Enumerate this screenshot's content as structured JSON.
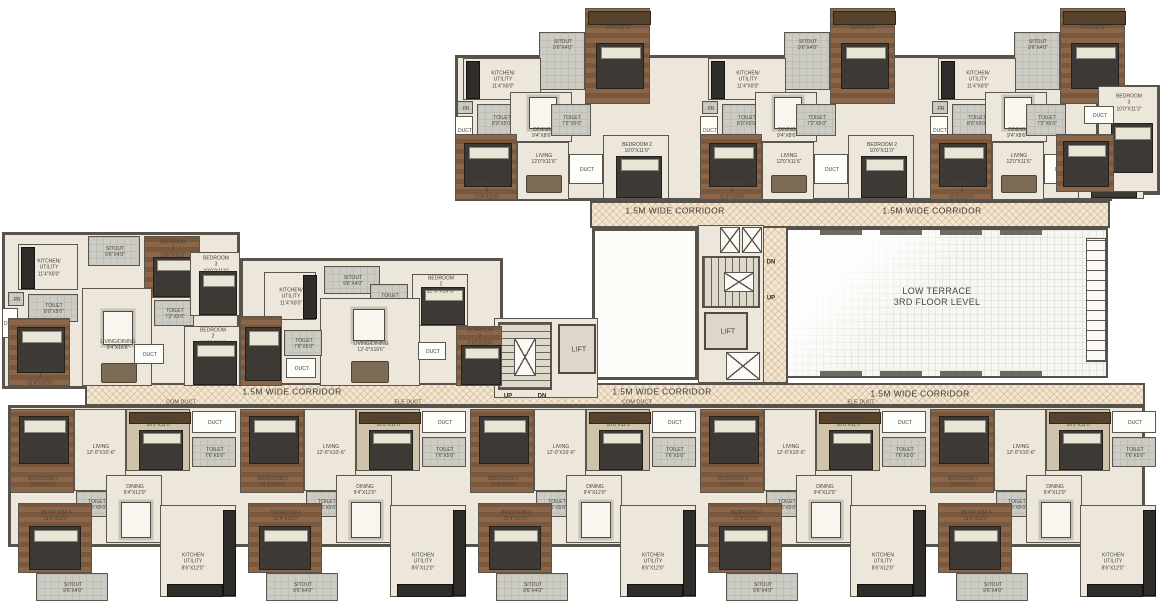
{
  "canvas": {
    "w": 1160,
    "h": 605
  },
  "colors": {
    "wall": "#57534b",
    "cream": "#ece7da",
    "wood": "#8a674a",
    "corridor_base": "#f2e6d3",
    "hatch": "#ba935e",
    "terrace": "#f6f6f2",
    "label": "#46423b"
  },
  "terrace": {
    "x": 786,
    "y": 228,
    "w": 322,
    "h": 150,
    "line1": "LOW TERRACE",
    "line2": "3RD FLOOR LEVEL",
    "louver": {
      "x": 1086,
      "y": 238,
      "w": 20,
      "h": 124
    },
    "edge_marks_top": [
      820,
      880,
      940,
      1000
    ],
    "edge_marks_bottom": [
      820,
      880,
      940,
      1000
    ]
  },
  "white_room": {
    "x": 592,
    "y": 228,
    "w": 106,
    "h": 152
  },
  "slabs": [
    {
      "x": 455,
      "y": 55,
      "w": 657,
      "h": 146
    },
    {
      "x": 1096,
      "y": 85,
      "w": 64,
      "h": 110
    },
    {
      "x": 2,
      "y": 232,
      "w": 238,
      "h": 157
    },
    {
      "x": 240,
      "y": 258,
      "w": 263,
      "h": 131
    },
    {
      "x": 8,
      "y": 405,
      "w": 1137,
      "h": 142
    }
  ],
  "corridors": [
    {
      "x": 590,
      "y": 201,
      "w": 520,
      "h": 27,
      "labels": [
        {
          "text": "1.5M WIDE CORRIDOR",
          "cx": 675,
          "cy": 211
        },
        {
          "text": "1.5M WIDE CORRIDOR",
          "cx": 932,
          "cy": 211
        }
      ]
    },
    {
      "x": 762,
      "y": 226,
      "w": 26,
      "h": 158,
      "labels": []
    },
    {
      "x": 85,
      "y": 383,
      "w": 1060,
      "h": 23,
      "labels": [
        {
          "text": "1.5M WIDE CORRIDOR",
          "cx": 292,
          "cy": 392
        },
        {
          "text": "1.5M WIDE CORRIDOR",
          "cx": 662,
          "cy": 392
        },
        {
          "text": "1.5M WIDE CORRIDOR",
          "cx": 920,
          "cy": 394
        }
      ]
    }
  ],
  "duct_tags": [
    {
      "text": "COM DUCT",
      "cx": 181,
      "cy": 403
    },
    {
      "text": "ELE DUCT",
      "cx": 408,
      "cy": 403
    },
    {
      "text": "COM DUCT",
      "cx": 637,
      "cy": 403
    },
    {
      "text": "ELE DUCT",
      "cx": 861,
      "cy": 403
    }
  ],
  "cores": [
    {
      "name": "core-1",
      "frame": {
        "x": 494,
        "y": 318,
        "w": 104,
        "h": 80
      },
      "stair": {
        "x": 498,
        "y": 322,
        "w": 54,
        "h": 68,
        "dir": "v"
      },
      "mid_x": {
        "x": 514,
        "y": 338,
        "w": 22,
        "h": 38
      },
      "lift": {
        "x": 558,
        "y": 324,
        "w": 38,
        "h": 50,
        "label": "LIFT"
      },
      "xboxes": [],
      "updn": [
        {
          "text": "UP",
          "cx": 508,
          "cy": 397
        },
        {
          "text": "DN",
          "cx": 542,
          "cy": 397
        }
      ]
    },
    {
      "name": "core-2",
      "frame": {
        "x": 698,
        "y": 225,
        "w": 66,
        "h": 158
      },
      "stair": {
        "x": 702,
        "y": 256,
        "w": 58,
        "h": 52,
        "dir": "h"
      },
      "mid_x": {
        "x": 724,
        "y": 272,
        "w": 30,
        "h": 20
      },
      "lift": {
        "x": 704,
        "y": 312,
        "w": 44,
        "h": 38,
        "label": "LIFT"
      },
      "xboxes": [
        {
          "x": 720,
          "y": 227,
          "w": 20,
          "h": 26
        },
        {
          "x": 742,
          "y": 227,
          "w": 20,
          "h": 26
        },
        {
          "x": 726,
          "y": 352,
          "w": 34,
          "h": 28
        }
      ],
      "updn": [
        {
          "text": "DN",
          "cx": 771,
          "cy": 263
        },
        {
          "text": "UP",
          "cx": 771,
          "cy": 299
        }
      ]
    }
  ],
  "unit_templates": {
    "top_unit": {
      "rooms": [
        {
          "x": 130,
          "y": 0,
          "w": 65,
          "h": 96,
          "f": "wood",
          "label": "BEDROOM 3",
          "dims": "10'0\"X11'3\"",
          "l": [
            32,
            16
          ],
          "furn": [
            {
              "t": "ward",
              "x": 2,
              "y": 2,
              "w": 61,
              "h": 12
            },
            {
              "t": "bed",
              "x": 10,
              "y": 34,
              "w": 46,
              "h": 44
            }
          ]
        },
        {
          "x": 84,
          "y": 24,
          "w": 46,
          "h": 58,
          "f": "gray",
          "label": "SITOUT",
          "dims": "9'6\"X4'0\"",
          "l": [
            23,
            12
          ],
          "furn": []
        },
        {
          "x": 8,
          "y": 50,
          "w": 78,
          "h": 42,
          "f": "cream",
          "label": "KITCHEN/\nUTILITY",
          "dims": "11'4\"X8'0\"",
          "furn": [
            {
              "t": "counter",
              "x": 2,
              "y": 2,
              "w": 12,
              "h": 36
            }
          ]
        },
        {
          "x": 2,
          "y": 93,
          "w": 16,
          "h": 13,
          "f": "gray",
          "label": "PR",
          "furn": []
        },
        {
          "x": 0,
          "y": 108,
          "w": 18,
          "h": 28,
          "f": "white",
          "label": "DUCT",
          "furn": []
        },
        {
          "x": 22,
          "y": 96,
          "w": 48,
          "h": 32,
          "f": "gray",
          "label": "TOILET",
          "dims": "8'0\"X5'0\"",
          "furn": []
        },
        {
          "x": 55,
          "y": 84,
          "w": 62,
          "h": 50,
          "f": "cream",
          "label": "DINING",
          "dims": "9'4\"X8'6\"",
          "l": [
            31,
            40
          ],
          "furn": [
            {
              "t": "table",
              "x": 18,
              "y": 4,
              "w": 26,
              "h": 30
            }
          ]
        },
        {
          "x": 96,
          "y": 96,
          "w": 40,
          "h": 32,
          "f": "gray",
          "label": "TOILET",
          "dims": "7'2\"X5'0\"",
          "furn": []
        },
        {
          "x": 0,
          "y": 126,
          "w": 62,
          "h": 66,
          "f": "wood",
          "label": "BEDROOM 4",
          "dims": "11'3\"X10'0\"",
          "l": [
            31,
            56
          ],
          "furn": [
            {
              "t": "bed",
              "x": 8,
              "y": 8,
              "w": 46,
              "h": 42
            }
          ]
        },
        {
          "x": 62,
          "y": 134,
          "w": 52,
          "h": 58,
          "f": "cream",
          "label": "LIVING",
          "dims": "12'0\"X11'6\"",
          "l": [
            26,
            16
          ],
          "furn": [
            {
              "t": "sofa",
              "x": 8,
              "y": 32,
              "w": 34,
              "h": 16
            }
          ]
        },
        {
          "x": 114,
          "y": 146,
          "w": 34,
          "h": 30,
          "f": "white",
          "label": "DUCT",
          "furn": []
        },
        {
          "x": 148,
          "y": 127,
          "w": 66,
          "h": 64,
          "f": "cream",
          "label": "BEDROOM 2",
          "dims": "10'0\"X11'0\"",
          "l": [
            33,
            12
          ],
          "furn": [
            {
              "t": "bed",
              "x": 12,
              "y": 20,
              "w": 44,
              "h": 40
            }
          ]
        }
      ]
    },
    "mid_unit_a": {
      "rooms": [
        {
          "x": 16,
          "y": 12,
          "w": 60,
          "h": 46,
          "f": "cream",
          "label": "KITCHEN/\nUTILITY",
          "dims": "11'4\"X8'0\"",
          "furn": [
            {
              "t": "counter",
              "x": 2,
              "y": 2,
              "w": 12,
              "h": 40
            }
          ]
        },
        {
          "x": 86,
          "y": 4,
          "w": 52,
          "h": 30,
          "f": "gray",
          "label": "SITOUT",
          "dims": "9'6\"X4'0\"",
          "furn": []
        },
        {
          "x": 142,
          "y": 4,
          "w": 56,
          "h": 62,
          "f": "wood",
          "label": "BEDROOM 3",
          "dims": "10'0\"X11'3\"",
          "l": [
            28,
            12
          ],
          "furn": [
            {
              "t": "bed",
              "x": 8,
              "y": 20,
              "w": 40,
              "h": 38
            }
          ]
        },
        {
          "x": 6,
          "y": 60,
          "w": 16,
          "h": 14,
          "f": "gray",
          "label": "PR",
          "furn": []
        },
        {
          "x": 0,
          "y": 76,
          "w": 16,
          "h": 30,
          "f": "white",
          "label": "DUCT",
          "furn": []
        },
        {
          "x": 26,
          "y": 62,
          "w": 50,
          "h": 28,
          "f": "gray",
          "label": "TOILET",
          "dims": "8'0\"X5'0\"",
          "furn": []
        },
        {
          "x": 80,
          "y": 56,
          "w": 70,
          "h": 98,
          "f": "cream",
          "label": "LIVING/DINING",
          "dims": "9'4\"X16'6\"",
          "l": [
            35,
            56
          ],
          "furn": [
            {
              "t": "table",
              "x": 20,
              "y": 22,
              "w": 28,
              "h": 32
            },
            {
              "t": "sofa",
              "x": 18,
              "y": 74,
              "w": 34,
              "h": 18
            }
          ]
        },
        {
          "x": 152,
          "y": 68,
          "w": 40,
          "h": 26,
          "f": "gray",
          "label": "TOILET",
          "dims": "7'2\"X5'0\"",
          "furn": []
        },
        {
          "x": 188,
          "y": 20,
          "w": 50,
          "h": 64,
          "f": "cream",
          "label": "BEDROOM 3",
          "dims": "10'0\"X11'0\"",
          "l": [
            25,
            12
          ],
          "furn": [
            {
              "t": "bed",
              "x": 8,
              "y": 18,
              "w": 36,
              "h": 42
            }
          ]
        },
        {
          "x": 182,
          "y": 94,
          "w": 56,
          "h": 60,
          "f": "cream",
          "label": "BEDROOM 2",
          "dims": "10'0\"X11'0\"",
          "l": [
            28,
            10
          ],
          "furn": [
            {
              "t": "bed",
              "x": 8,
              "y": 14,
              "w": 42,
              "h": 42
            }
          ]
        },
        {
          "x": 6,
          "y": 86,
          "w": 62,
          "h": 68,
          "f": "wood",
          "label": "BEDROOM 4",
          "dims": "11'4\"X10'0\"",
          "l": [
            31,
            58
          ],
          "furn": [
            {
              "t": "bed",
              "x": 8,
              "y": 8,
              "w": 46,
              "h": 44
            }
          ]
        },
        {
          "x": 132,
          "y": 112,
          "w": 30,
          "h": 20,
          "f": "white",
          "label": "DUCT",
          "furn": []
        }
      ]
    },
    "mid_unit_b": {
      "rooms": [
        {
          "x": 24,
          "y": 14,
          "w": 52,
          "h": 48,
          "f": "cream",
          "label": "KITCHEN/\nUTILITY",
          "dims": "11'4\"X8'0\"",
          "furn": [
            {
              "t": "counter",
              "x": 38,
              "y": 2,
              "w": 12,
              "h": 42
            }
          ]
        },
        {
          "x": 84,
          "y": 8,
          "w": 56,
          "h": 28,
          "f": "gray",
          "label": "SITOUT",
          "dims": "9'6\"X4'0\"",
          "furn": []
        },
        {
          "x": 130,
          "y": 26,
          "w": 38,
          "h": 28,
          "f": "gray",
          "label": "TOILET",
          "dims": "7'2\"X5'0\"",
          "furn": []
        },
        {
          "x": 172,
          "y": 16,
          "w": 56,
          "h": 52,
          "f": "cream",
          "label": "BEDROOM 2",
          "dims": "12'-0\"X10'-0\"",
          "l": [
            28,
            10
          ],
          "furn": [
            {
              "t": "bed",
              "x": 8,
              "y": 12,
              "w": 42,
              "h": 36
            }
          ]
        },
        {
          "x": 216,
          "y": 68,
          "w": 46,
          "h": 60,
          "f": "wood",
          "label": "BEDROOM 2",
          "dims": "7'10\"X10'6\"",
          "l": [
            23,
            10
          ],
          "furn": [
            {
              "t": "bed",
              "x": 4,
              "y": 18,
              "w": 38,
              "h": 38
            }
          ]
        },
        {
          "x": 80,
          "y": 40,
          "w": 100,
          "h": 88,
          "f": "cream",
          "label": "LIVING/DINING",
          "dims": "12'-0\"X16'6\"",
          "l": [
            50,
            48
          ],
          "furn": [
            {
              "t": "table",
              "x": 32,
              "y": 10,
              "w": 30,
              "h": 30
            },
            {
              "t": "sofa",
              "x": 30,
              "y": 62,
              "w": 36,
              "h": 20
            }
          ]
        },
        {
          "x": 44,
          "y": 72,
          "w": 38,
          "h": 26,
          "f": "gray",
          "label": "TOILET",
          "dims": "7'6\"X5'0\"",
          "furn": []
        },
        {
          "x": 46,
          "y": 100,
          "w": 30,
          "h": 20,
          "f": "white",
          "label": "DUCT",
          "furn": []
        },
        {
          "x": 0,
          "y": 58,
          "w": 42,
          "h": 70,
          "f": "wood",
          "furn": [
            {
              "t": "bed",
              "x": 4,
              "y": 10,
              "w": 34,
              "h": 52
            }
          ]
        },
        {
          "x": 178,
          "y": 84,
          "w": 28,
          "h": 18,
          "f": "white",
          "label": "DUCT",
          "furn": []
        }
      ]
    },
    "bottom_unit": {
      "rooms": [
        {
          "x": 2,
          "y": 4,
          "w": 64,
          "h": 84,
          "f": "wood",
          "label": "BEDROOM 2",
          "dims": "11'3\"X10'0\"",
          "l": [
            32,
            72
          ],
          "furn": [
            {
              "t": "bed",
              "x": 8,
              "y": 6,
              "w": 48,
              "h": 46
            }
          ]
        },
        {
          "x": 66,
          "y": 4,
          "w": 52,
          "h": 82,
          "f": "cream",
          "label": "LIVING",
          "dims": "12'-0\"X10'-6\"",
          "l": [
            26,
            40
          ],
          "furn": []
        },
        {
          "x": 118,
          "y": 4,
          "w": 64,
          "h": 62,
          "f": "tan",
          "label": "BEDROOM 3",
          "dims": "10'0\"X11'0\"",
          "l": [
            32,
            12
          ],
          "furn": [
            {
              "t": "ward",
              "x": 2,
              "y": 2,
              "w": 60,
              "h": 10
            },
            {
              "t": "bed",
              "x": 12,
              "y": 20,
              "w": 42,
              "h": 38
            }
          ]
        },
        {
          "x": 184,
          "y": 6,
          "w": 44,
          "h": 22,
          "f": "white",
          "label": "DUCT",
          "furn": []
        },
        {
          "x": 184,
          "y": 32,
          "w": 44,
          "h": 30,
          "f": "gray",
          "label": "TOILET",
          "dims": "7'6\"X5'0\"",
          "furn": []
        },
        {
          "x": 68,
          "y": 86,
          "w": 40,
          "h": 26,
          "f": "gray",
          "label": "TOILET",
          "dims": "7'6\"X5'0\"",
          "furn": []
        },
        {
          "x": 98,
          "y": 70,
          "w": 56,
          "h": 68,
          "f": "cream",
          "label": "DINING",
          "dims": "9'4\"X12'0\"",
          "l": [
            28,
            14
          ],
          "furn": [
            {
              "t": "table",
              "x": 14,
              "y": 26,
              "w": 28,
              "h": 34
            }
          ]
        },
        {
          "x": 10,
          "y": 98,
          "w": 74,
          "h": 70,
          "f": "wood",
          "label": "BEDROOM 4",
          "dims": "11'4\"X12'0\"",
          "l": [
            37,
            12
          ],
          "furn": [
            {
              "t": "bed",
              "x": 10,
              "y": 22,
              "w": 50,
              "h": 42
            }
          ]
        },
        {
          "x": 28,
          "y": 168,
          "w": 72,
          "h": 28,
          "f": "gray",
          "label": "SITOUT",
          "dims": "9'6\"X4'0\"",
          "furn": []
        },
        {
          "x": 152,
          "y": 100,
          "w": 76,
          "h": 92,
          "f": "cream",
          "label": "KITCHEN\nUTILITY",
          "dims": "8'6\"X12'0\"",
          "l": [
            32,
            56
          ],
          "furn": [
            {
              "t": "counter",
              "x": 62,
              "y": 4,
              "w": 11,
              "h": 84
            },
            {
              "t": "counter",
              "x": 6,
              "y": 78,
              "w": 54,
              "h": 11
            }
          ]
        }
      ]
    }
  },
  "units": [
    {
      "template": "top_unit",
      "x": 455,
      "y": 8
    },
    {
      "template": "top_unit",
      "x": 700,
      "y": 8
    },
    {
      "template": "top_unit",
      "x": 930,
      "y": 8
    },
    {
      "template": "mid_unit_a",
      "x": 2,
      "y": 232
    },
    {
      "template": "mid_unit_b",
      "x": 240,
      "y": 258
    },
    {
      "template": "bottom_unit",
      "x": 8,
      "y": 405
    },
    {
      "template": "bottom_unit",
      "x": 238,
      "y": 405
    },
    {
      "template": "bottom_unit",
      "x": 468,
      "y": 405
    },
    {
      "template": "bottom_unit",
      "x": 698,
      "y": 405
    },
    {
      "template": "bottom_unit",
      "x": 928,
      "y": 405
    }
  ],
  "extra_rooms": [
    {
      "x": 1098,
      "y": 86,
      "w": 60,
      "h": 106,
      "f": "cream",
      "label": "BEDROOM 3",
      "dims": "10'0\"X11'3\"",
      "l": [
        30,
        16
      ],
      "furn": [
        {
          "t": "bed",
          "x": 12,
          "y": 36,
          "w": 40,
          "h": 48
        }
      ]
    },
    {
      "x": 1056,
      "y": 134,
      "w": 58,
      "h": 58,
      "f": "wood",
      "furn": [
        {
          "t": "bed",
          "x": 6,
          "y": 6,
          "w": 44,
          "h": 44
        }
      ]
    },
    {
      "x": 1084,
      "y": 106,
      "w": 30,
      "h": 18,
      "f": "white",
      "label": "DUCT",
      "furn": []
    }
  ]
}
